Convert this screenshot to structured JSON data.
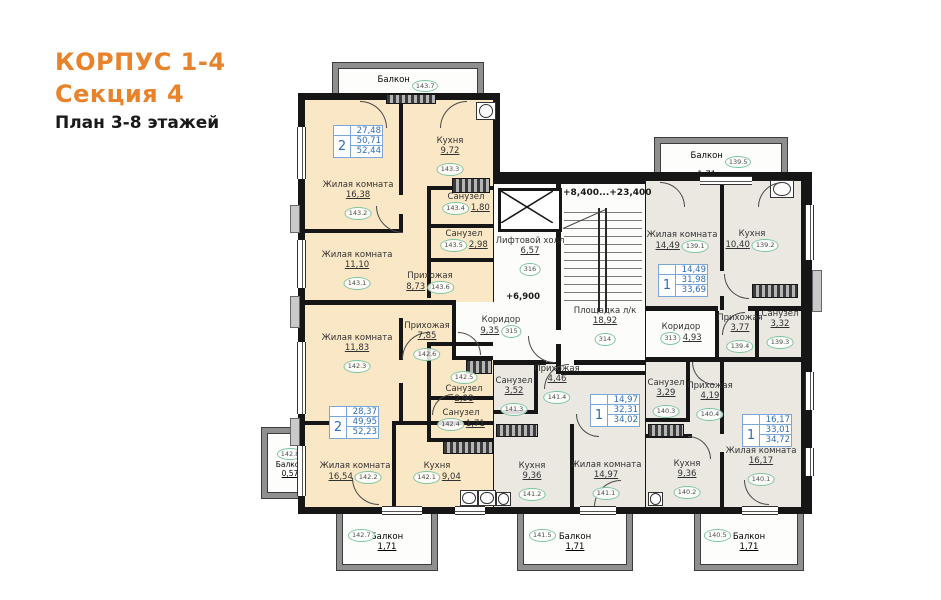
{
  "title": {
    "line1": "КОРПУС 1-4",
    "line2": "Секция 4",
    "line3": "План 3-8 этажей"
  },
  "levels": {
    "stairs_range": "+8,400...+23,400",
    "hall_level": "+6,900"
  },
  "colors": {
    "accent_orange": "#e8832c",
    "apartment_warm": "#fae7c5",
    "apartment_gray": "#ebe8e2",
    "tag_green": "#7cc5a0",
    "info_blue": "#2f6db8"
  },
  "apartments": [
    {
      "rooms": "2",
      "living": "27,48",
      "area": "50,71",
      "total": "52,44"
    },
    {
      "rooms": "2",
      "living": "28,37",
      "area": "49,95",
      "total": "52,23"
    },
    {
      "rooms": "1",
      "living": "14,49",
      "area": "31,98",
      "total": "33,69"
    },
    {
      "rooms": "1",
      "living": "14,97",
      "area": "32,31",
      "total": "34,02"
    },
    {
      "rooms": "1",
      "living": "16,17",
      "area": "33,01",
      "total": "34,72"
    }
  ],
  "rooms": [
    {
      "name": "Балкон",
      "area": "1,73",
      "tag": "143.7"
    },
    {
      "name": "Кухня",
      "area": "9,72",
      "tag": "143.3"
    },
    {
      "name": "Жилая комната",
      "area": "16,38",
      "tag": "143.2"
    },
    {
      "name": "Санузел",
      "area": "1,80",
      "tag": "143.4"
    },
    {
      "name": "Санузел",
      "area": "2,98",
      "tag": "143.5"
    },
    {
      "name": "Жилая комната",
      "area": "11,10",
      "tag": "143.1"
    },
    {
      "name": "Прихожая",
      "area": "8,73",
      "tag": "143.6"
    },
    {
      "name": "Жилая комната",
      "area": "11,83",
      "tag": "142.3"
    },
    {
      "name": "Прихожая",
      "area": "7,85",
      "tag": "142.6"
    },
    {
      "name": "Санузел",
      "area": "2,98",
      "tag": "142.5"
    },
    {
      "name": "Санузел",
      "area": "1,71",
      "tag": "142.4"
    },
    {
      "name": "Жилая комната",
      "area": "16,54",
      "tag": "142.2"
    },
    {
      "name": "Кухня",
      "area": "9,04",
      "tag": "142.1"
    },
    {
      "name": "Балкон",
      "area": "0,57",
      "tag": "142.8"
    },
    {
      "name": "Балкон",
      "area": "1,71",
      "tag": "142.7"
    },
    {
      "name": "Лифтовой холл",
      "area": "6,57",
      "tag": "316"
    },
    {
      "name": "Коридор",
      "area": "9,35",
      "tag": "315"
    },
    {
      "name": "Площадка л/к",
      "area": "18,92",
      "tag": "314"
    },
    {
      "name": "Балкон",
      "area": "1,71",
      "tag": "139.5"
    },
    {
      "name": "Жилая комната",
      "area": "14,49",
      "tag": "139.1"
    },
    {
      "name": "Кухня",
      "area": "10,40",
      "tag": "139.2"
    },
    {
      "name": "Прихожая",
      "area": "3,77",
      "tag": "139.4"
    },
    {
      "name": "Санузел",
      "area": "3,32",
      "tag": "139.3"
    },
    {
      "name": "Коридор",
      "area": "4,93",
      "tag": "313"
    },
    {
      "name": "Санузел",
      "area": "3,29",
      "tag": "140.3"
    },
    {
      "name": "Прихожая",
      "area": "4,19",
      "tag": "140.4"
    },
    {
      "name": "Кухня",
      "area": "9,36",
      "tag": "140.2"
    },
    {
      "name": "Жилая комната",
      "area": "16,17",
      "tag": "140.1"
    },
    {
      "name": "Балкон",
      "area": "1,71",
      "tag": "140.5"
    },
    {
      "name": "Санузел",
      "area": "3,52",
      "tag": "141.3"
    },
    {
      "name": "Прихожая",
      "area": "4,46",
      "tag": "141.4"
    },
    {
      "name": "Кухня",
      "area": "9,36",
      "tag": "141.2"
    },
    {
      "name": "Жилая комната",
      "area": "14,97",
      "tag": "141.1"
    },
    {
      "name": "Балкон",
      "area": "1,71",
      "tag": "141.5"
    }
  ]
}
